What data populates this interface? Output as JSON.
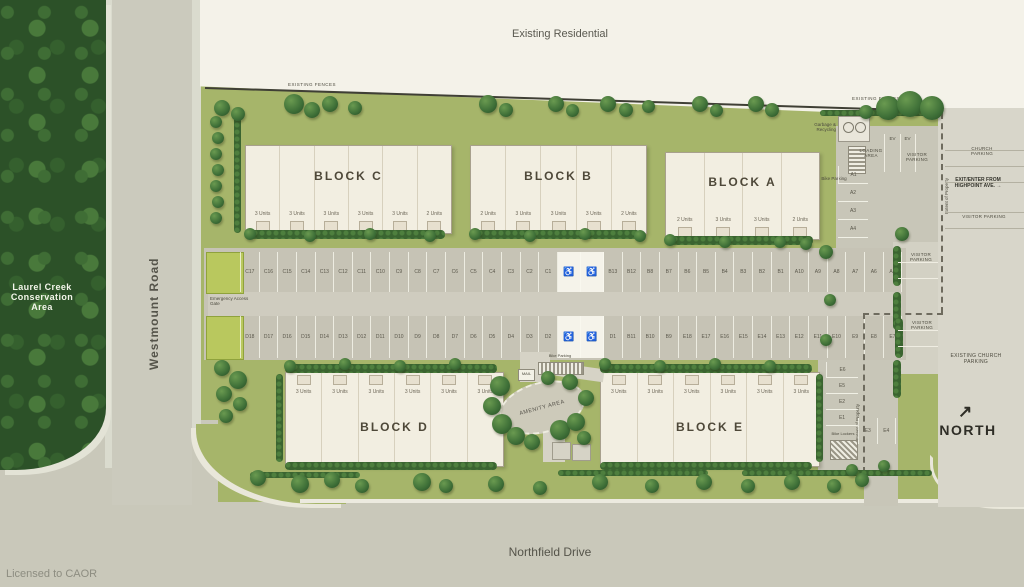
{
  "areas": {
    "existing_residential": "Existing Residential",
    "conservation": "Laurel Creek Conservation Area",
    "existing_church_parking": "EXISTING CHURCH PARKING",
    "north": "NORTH",
    "north_arrow": "↗"
  },
  "roads": {
    "west": "Westmount Road",
    "south": "Northfield Drive"
  },
  "fences": {
    "left": "EXISTING FENCES",
    "right": "EXISTING FENCES"
  },
  "credit": "Licensed to CAOR",
  "blocks": [
    {
      "id": "C",
      "label": "BLOCK C",
      "units": [
        "3 Units",
        "3 Units",
        "3 Units",
        "3 Units",
        "3 Units",
        "2 Units"
      ]
    },
    {
      "id": "B",
      "label": "BLOCK B",
      "units": [
        "2 Units",
        "3 Units",
        "3 Units",
        "3 Units",
        "2 Units"
      ]
    },
    {
      "id": "A",
      "label": "BLOCK A",
      "units": [
        "2 Units",
        "3 Units",
        "3 Units",
        "2 Units"
      ]
    },
    {
      "id": "D",
      "label": "BLOCK D",
      "units": [
        "3 Units",
        "3 Units",
        "3 Units",
        "3 Units",
        "3 Units",
        "3 Units"
      ]
    },
    {
      "id": "E",
      "label": "BLOCK E",
      "units": [
        "3 Units",
        "3 Units",
        "3 Units",
        "3 Units",
        "3 Units",
        "3 Units"
      ]
    }
  ],
  "parking": {
    "row1": [
      "C17",
      "C16",
      "C15",
      "C14",
      "C13",
      "C12",
      "C11",
      "C10",
      "C9",
      "C8",
      "C7",
      "C6",
      "C5",
      "C4",
      "C3",
      "C2",
      "C1",
      "♿",
      "♿",
      "B13",
      "B12",
      "B8",
      "B7",
      "B6",
      "B5",
      "B4",
      "B3",
      "B2",
      "B1",
      "A10",
      "A9",
      "A8",
      "A7",
      "A6",
      "A5"
    ],
    "row2": [
      "D18",
      "D17",
      "D16",
      "D15",
      "D14",
      "D13",
      "D12",
      "D11",
      "D10",
      "D9",
      "D8",
      "D7",
      "D6",
      "D5",
      "D4",
      "D3",
      "D2",
      "♿",
      "♿",
      "D1",
      "B11",
      "B10",
      "B9",
      "E18",
      "E17",
      "E16",
      "E15",
      "E14",
      "E13",
      "E12",
      "E11",
      "E10",
      "E9",
      "E8",
      "E7"
    ],
    "a_column": [
      "A1",
      "A2",
      "A3",
      "A4"
    ],
    "e_column": [
      "E6",
      "E5",
      "E2",
      "E1"
    ],
    "e_pair": [
      "E3",
      "E4"
    ]
  },
  "labels": {
    "emergency_gate": "Emergency Access Gate",
    "garbage": "Garbage & Recycling",
    "bike_parking_top": "Bike Parking",
    "bike_parking_amenity": "Bike Parking",
    "bike_lockers": "Bike Lockers",
    "loading": "LOADING AREA",
    "ev_1": "EV",
    "ev_2": "EV",
    "visitor_1": "VISITOR PARKING",
    "visitor_2": "VISITOR PARKING",
    "visitor_3": "VISITOR PARKING",
    "visitor_4": "VISITOR PARKING",
    "church_parking": "CHURCH PARKING",
    "exit_enter": "EXIT/ENTER FROM HIGHPOINT AVE. →",
    "extent_1": "Extent of Property",
    "extent_2": "Extent of Property",
    "amenity": "AMENITY AREA",
    "mail": "MAIL"
  },
  "colors": {
    "site_green": "#a6b56a",
    "road_gray": "#c9c8ba",
    "building_cream": "#f2eee1",
    "forest_green": "#2c5128",
    "hedge_green": "#3a6430",
    "gate_green": "#b9c85e",
    "church_gray": "#d8d6ca"
  }
}
